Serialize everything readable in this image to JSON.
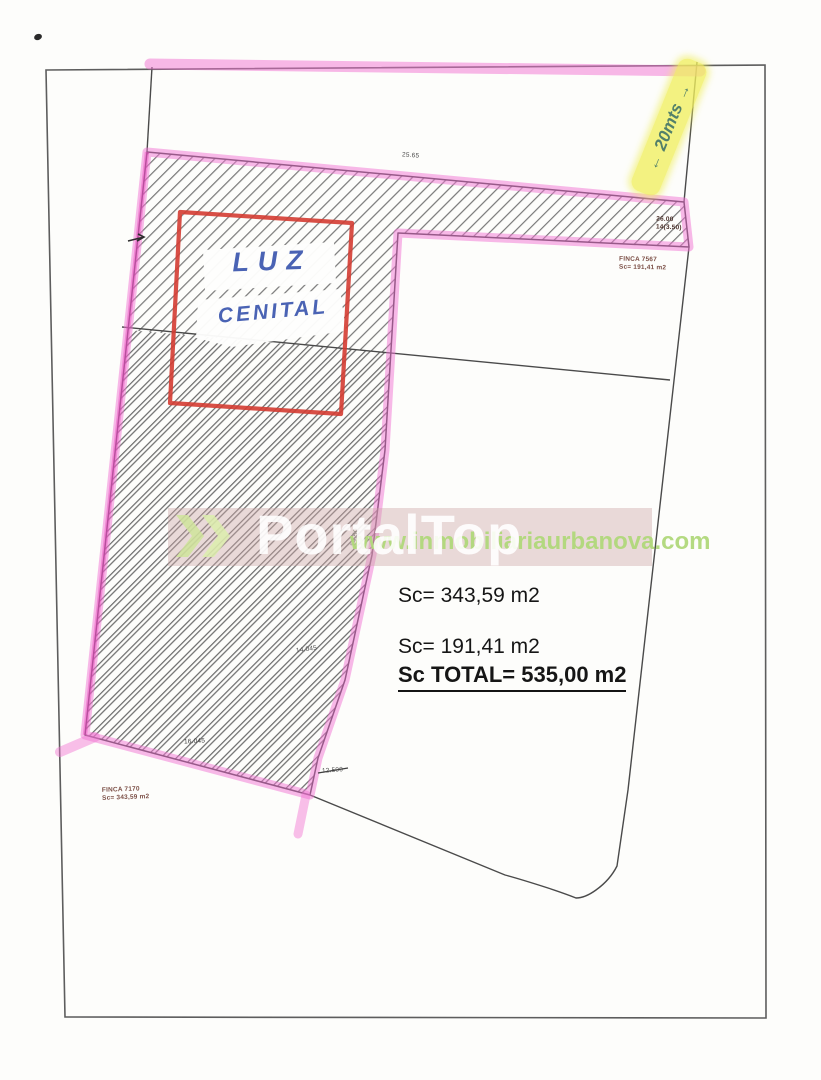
{
  "handwriting": {
    "measurement_note": {
      "arrow_start": "←",
      "text": "20mts",
      "arrow_end": "→"
    },
    "luz_label": {
      "line1": "LUZ",
      "line2": "CENITAL"
    }
  },
  "parcel_labels": {
    "finca_right": {
      "name": "FINCA 7567",
      "area": "Sc= 191,41 m2"
    },
    "finca_left": {
      "name": "FINCA 7170",
      "area": "Sc= 343,59 m2"
    }
  },
  "area_summary": {
    "sc1": "Sc= 343,59 m2",
    "sc2": "Sc= 191,41 m2",
    "total": "Sc TOTAL= 535,00 m2"
  },
  "dimensions": {
    "top_edge": "25.65",
    "strip_right_line1": "26.00",
    "strip_right_line2": "14(3.50)",
    "column_mid": "14.50",
    "column_lower": "14.045",
    "bottom_inner": "16.045",
    "bottom_edge": "12.500"
  },
  "watermark": {
    "brand": "PortalTop",
    "url": "www.inmobiliariaurbanova.com"
  },
  "colors": {
    "highlight_pink": "#f274d3",
    "highlight_yellow": "#efec5f",
    "ink_blue": "#4a63b4",
    "ink_green": "#5d8f6e",
    "outline_red": "#d43c32",
    "line_gray": "#4a4a4a"
  }
}
